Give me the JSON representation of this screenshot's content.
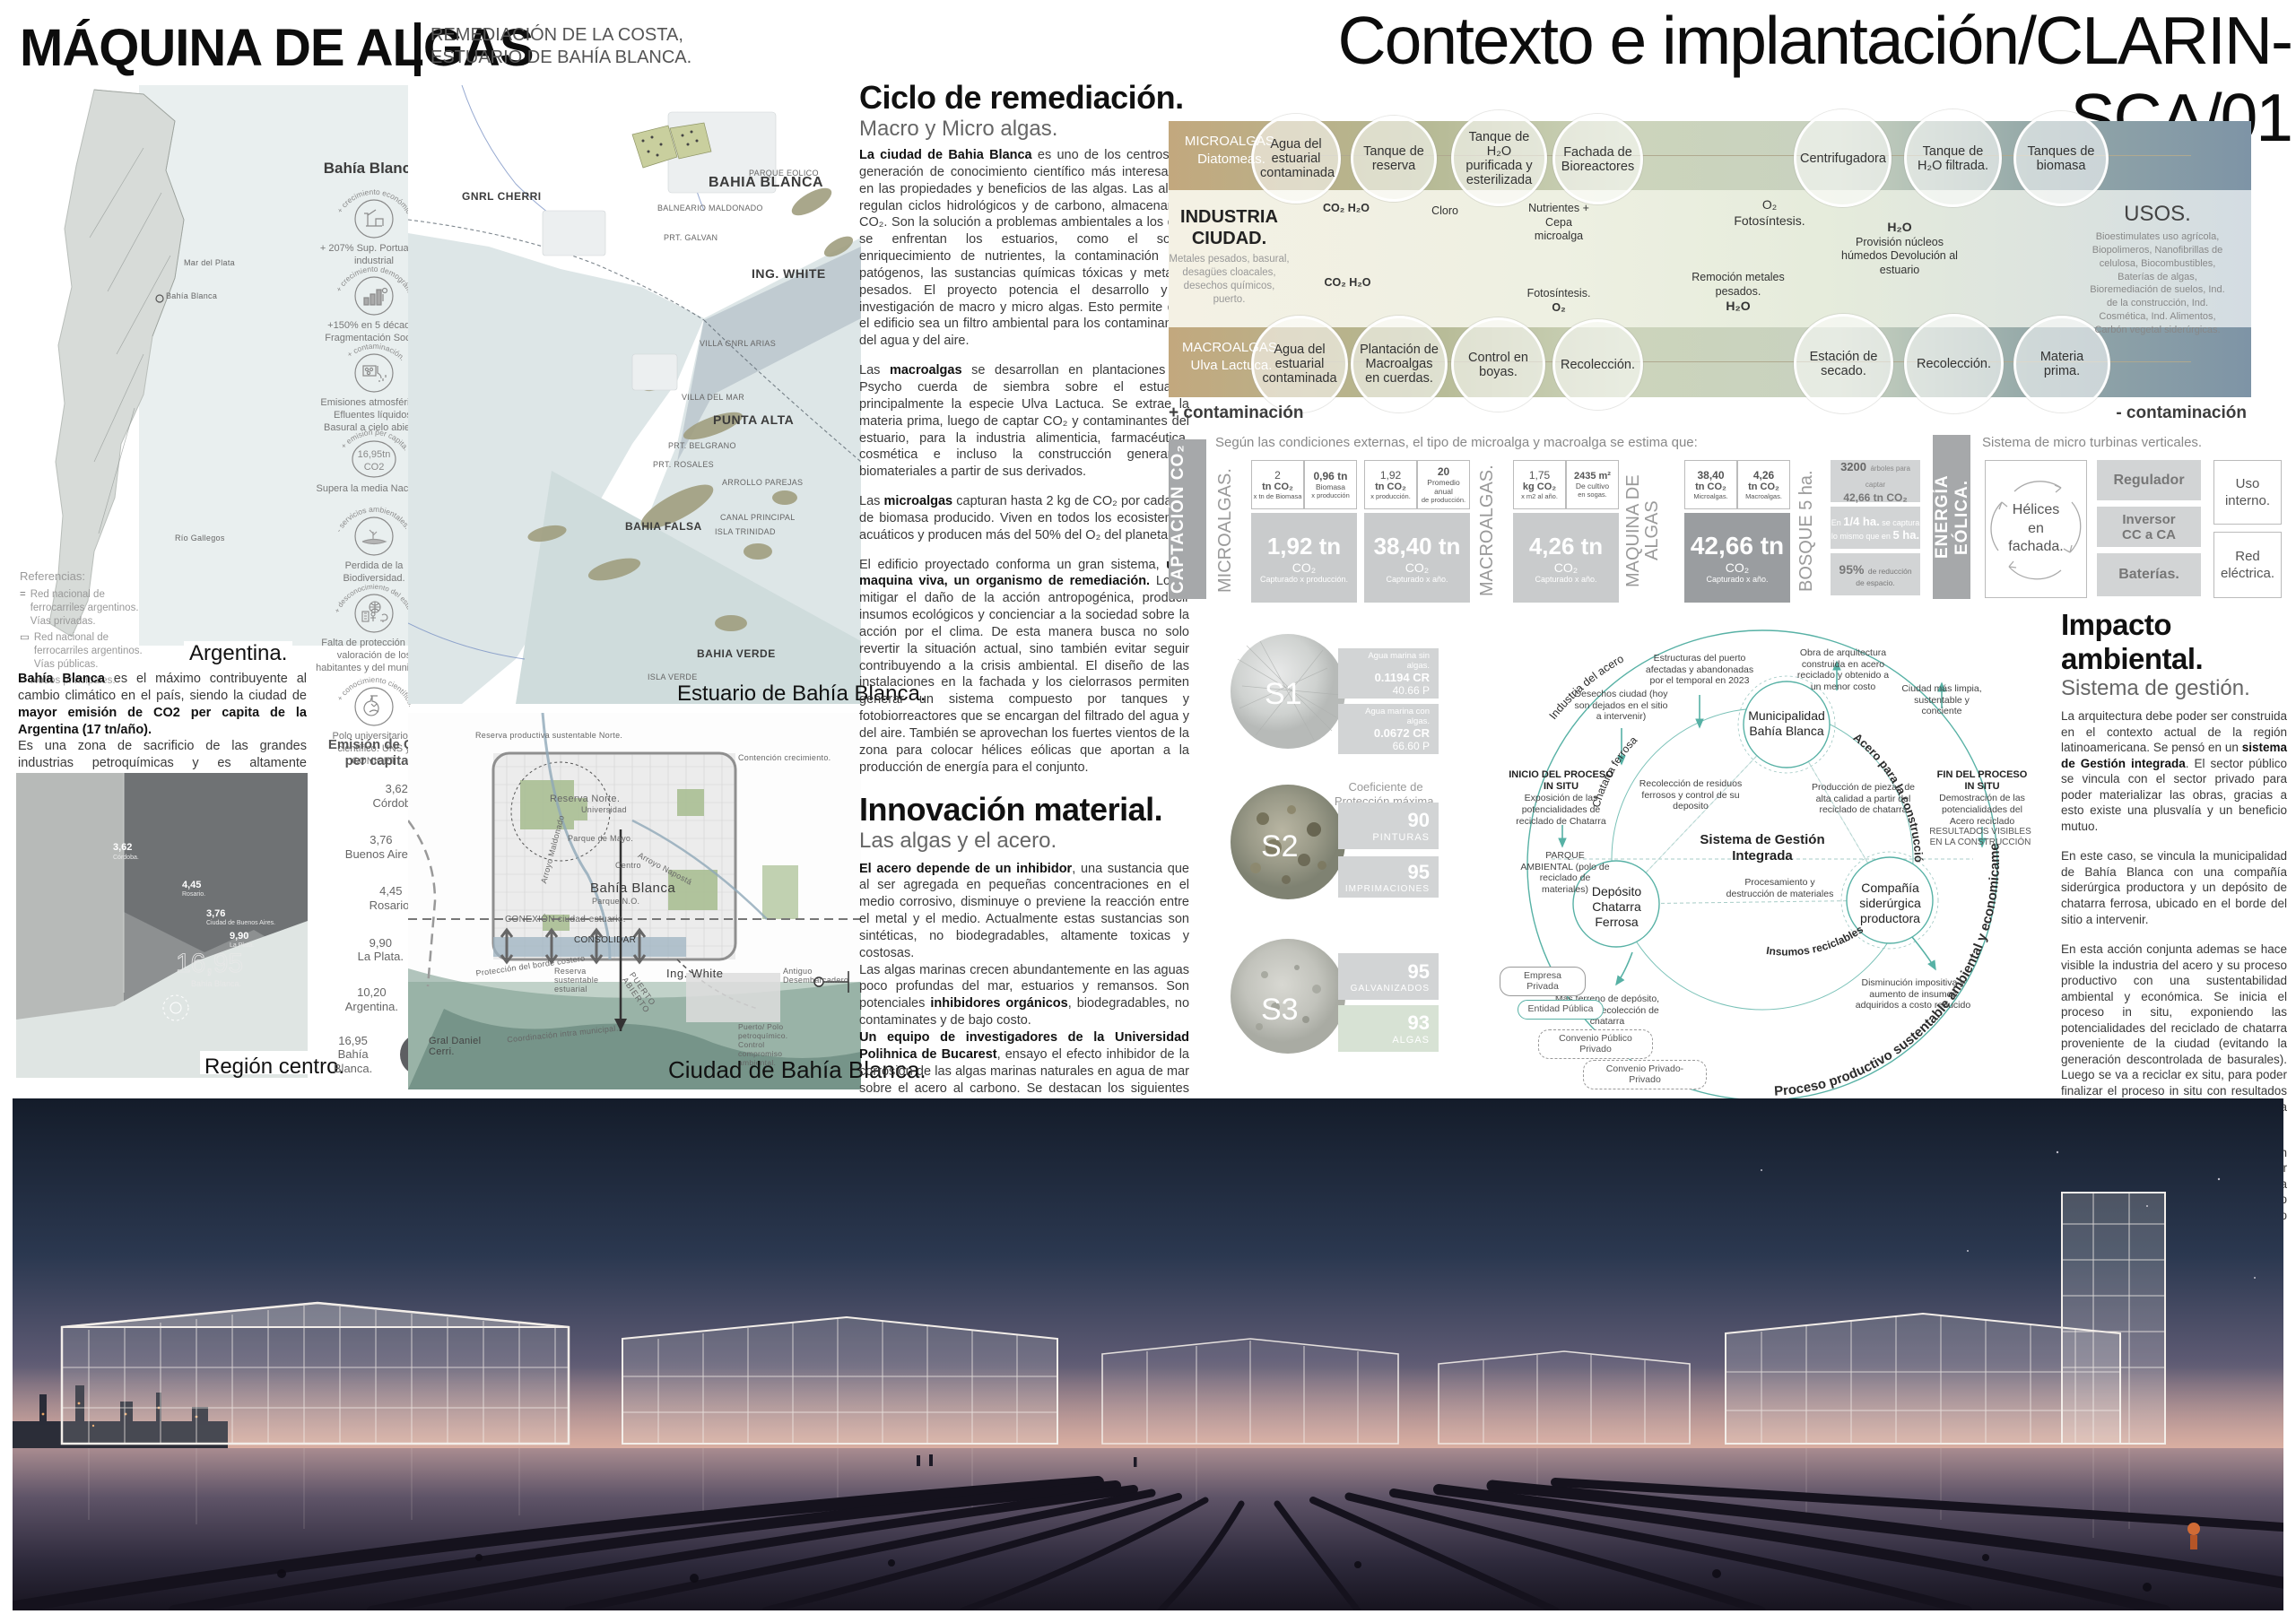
{
  "palette": {
    "tan": "#c0a67c",
    "olive": "#aab48e",
    "sage": "#cfd6bd",
    "steel": "#7e94a6",
    "teal": "#57b1a5",
    "gray_bar": "#a6a8aa",
    "cell_gray": "#d8d9da",
    "cell_dark": "#9a9da0",
    "algae_green": "#d7e2d4"
  },
  "header": {
    "title": "MÁQUINA DE ALGAS",
    "subtitle_line1": "REMEDIACIÓN DE LA COSTA,",
    "subtitle_line2": "ESTUARIO DE BAHÍA BLANCA.",
    "sheet_title": "Contexto e implantación/CLARIN-SCA/01"
  },
  "left": {
    "argentina_caption": "Argentina.",
    "region_caption": "Región centro.",
    "map_label_rio_gallegos": "Río Gallegos",
    "map_label_bahia": "Bahía Blanca",
    "map_label_mar": "Mar del Plata",
    "referencias": {
      "title": "Referencias:",
      "item1": "Red nacional de ferrocarriles argentinos. Vías privadas.",
      "item2": "Red nacional de ferrocarriles argentinos. Vías públicas.",
      "item3": "Nodos principales."
    },
    "bahia_header": "Bahía Blanca:",
    "icons": [
      {
        "arc": "+ crecimiento económico.",
        "caption": "+ 207% Sup. Portuaria e industrial"
      },
      {
        "arc": "+ crecimiento demográfico.",
        "caption": "+150% en 5 décadas Fragmentación Social."
      },
      {
        "arc": "+ contaminación.",
        "caption": "Emisiones atmosféricas. Efluentes líquidos. Basural a cielo abierto."
      },
      {
        "arc": "+ emisión per capita.",
        "caption": "Supera la media Nacional.",
        "value_line1": "16,95tn",
        "value_line2": "CO2"
      },
      {
        "arc": "- servicios ambientales.",
        "caption": "Perdida de la Biodiversidad."
      },
      {
        "arc": "+ desconocimiento del estuario.",
        "caption": "Falta de protección y de valoración de los habitantes y del municipio."
      },
      {
        "arc": "+ conocimiento científico.",
        "caption": "Polo universitario y científico. UNS y CONICET"
      }
    ],
    "para": {
      "b1": "Bahía Blanca",
      "t1": " es el máximo contribuyente al cambio climático en el país, siendo la ciudad de ",
      "b2": "mayor emisión de CO2 per capita de la Argentina (17 tn/año).",
      "t2": "Es una zona de sacrificio de las grandes industrias petroquímicas y es altamente vulnerable a la subida del nivel del mar, poniendo en riesgo a sus más de 300.000 habitantes."
    },
    "chart_data": {
      "type": "scatter",
      "title": "Emisión de CO₂ per capita:",
      "categories": [
        "Córdoba.",
        "Buenos Aires.",
        "Rosario.",
        "La Plata.",
        "Argentina.",
        "Bahía Blanca."
      ],
      "values": [
        3.62,
        3.76,
        4.45,
        9.9,
        10.2,
        16.95
      ],
      "value_labels": [
        "3,62",
        "3,76",
        "4,45",
        "9,90",
        "10,20",
        "16,95"
      ],
      "unit": "tn CO2 per capita"
    },
    "sat_bubbles": [
      {
        "v": "3,62",
        "n": "Córdoba."
      },
      {
        "v": "4,45",
        "n": "Rosario."
      },
      {
        "v": "3,76",
        "n": "Ciudad de Buenos Aires."
      },
      {
        "v": "9,90",
        "n": "La Plata."
      },
      {
        "v": "16,95",
        "n": "Bahía Blanca."
      }
    ]
  },
  "estuario": {
    "caption": "Estuario de Bahía Blanca.",
    "labels": [
      "GNRL CHERRI",
      "BAHIA BLANCA",
      "BALNEARIO MALDONADO",
      "PRT. GALVAN",
      "ING. WHITE",
      "VILLA GNRL ARIAS",
      "VILLA DEL MAR",
      "PUNTA ALTA",
      "PRT. BELGRANO",
      "PRT. ROSALES",
      "ARROLLO PAREJAS",
      "CANAL PRINCIPAL",
      "PARQUE EOLICO",
      "BAHIA FALSA",
      "ISLA TRINIDAD",
      "BAHIA VERDE",
      "ISLA VERDE"
    ]
  },
  "ciudad": {
    "caption": "Ciudad de Bahía Blanca.",
    "labels": [
      "Reserva productiva sustentable Norte.",
      "Contención crecimiento.",
      "Reserva Norte.",
      "Universidad",
      "Parque de Mayo.",
      "Arroyo Maldonado",
      "Arroyo Napostá",
      "Centro",
      "Bahía Blanca",
      "Parque N.O.",
      "CONEXIÓN ciudad-estuario.",
      "CONSOLIDAR",
      "Protección del borde costero",
      "Reserva sustentable estuarial",
      "Ing. White",
      "PUERTO ABIERTO",
      "Antiguo Desembarcadero",
      "Gral Daniel Cerri.",
      "Coordinación intra municipal.",
      "Puerto/ Polo petroquímico. Control compromiso ambiental."
    ]
  },
  "ciclo": {
    "h1": "Ciclo de remediación.",
    "h2": "Macro y Micro algas.",
    "p1b": "La ciudad de Bahia Blanca",
    "p1": " es uno de los centros de generación de conocimiento científico más interesados en las propiedades y beneficios de las algas. Las algas regulan ciclos hidrológicos y de carbono, almacenando CO₂. Son la solución a problemas ambientales a los que se enfrentan los estuarios, como el sobre enriquecimiento de nutrientes, la contaminación con patógenos, las sustancias químicas tóxicas y metales pesados. El proyecto potencia el desarrollo y la investigación de macro y micro algas. Esto permite que el edificio sea un filtro ambiental para los contaminantes del agua y del aire.",
    "p2a": "Las ",
    "p2b": "macroalgas",
    "p2": " se desarrollan en plantaciones de Psycho cuerda de siembra sobre el estuario, principalmente la especie Ulva Lactuca. Se extrae la materia prima, luego de captar CO₂ y contaminantes del estuario, para la industria alimenticia, farmacéutica, cosmética e incluso la construcción generando biomateriales a partir de sus derivados.",
    "p3a": "Las ",
    "p3b": "microalgas",
    "p3": " capturan hasta 2 kg de CO₂ por cada kg de biomasa producido. Viven en todos los ecosistemas acuáticos y producen más del 50% del O₂ del planeta.",
    "p4a": "El edificio proyectado conforma un gran sistema, ",
    "p4b": "una maquina viva, un organismo de remediación.",
    "p4": " Logra mitigar el daño de la acción antropogénica, producir insumos ecológicos y concienciar a la sociedad sobre la acción por el clima. De esta manera busca no solo revertir la situación actual, sino también evitar seguir contribuyendo a la crisis ambiental. El diseño de las instalaciones en la fachada y los cielorrasos permiten generar un sistema compuesto por tanques y fotobiorreactores que se encargan del filtrado del agua y del aire. También se aprovechan los fuertes vientos de la zona para colocar hélices eólicas que aportan a la producción de energía para el conjunto."
  },
  "innovacion": {
    "h1": "Innovación material.",
    "h2": "Las algas y el acero.",
    "p1b": "El acero depende de un inhibidor",
    "p1": ", una sustancia que al ser agregada en pequeñas concentraciones en el medio corrosivo, disminuye o previene la reacción entre el metal y el medio. Actualmente estas sustancias son sintéticas, no biodegradables, altamente toxicas y costosas.",
    "p2a": "Las algas marinas crecen abundantemente en las aguas poco profundas del mar, estuarios y remansos. Son potenciales ",
    "p2b": "inhibidores orgánicos",
    "p2": ", biodegradables, no contaminates y de bajo costo.",
    "p3b": "Un equipo de investigadores de la  Universidad Polihnica de Bucarest",
    "p3": ",  ensayo el efecto inhibidor de la corrosión de las algas marinas naturales en agua de mar sobre el acero al carbono. Se destacan los siguientes resultados de Velocidad de corrosión CR (g/m2 h) y grado de protección  P(%) en las siguientes morfologías superficiales del acero:",
    "s1": "- (S1) En blanco = CR 0.2012 / P-",
    "s2": "- (S2) Sumergido en agua de mar sin algas naturales  = CR 0.1194 / P- 40.66",
    "s3": "- (S3) Sumergido en agua de mar con algas naturales = CR 0.0672 / P- 66.60",
    "p4a": "Teniendo en cuenta esto, se plantea en el proyecto el ",
    "p4b": "uso de extracto de algas como inhibidor de la corrosión",
    "p4": " para evitar utilizar métodos contaminantes. Por otro lado, se  incorporan algas nativas en el agua en el cual se sumerge la estructura para aumentar su grado de protección y disminuir su velocidad de corrosión,prolongando la vida útil mas larga y con menor impacto ambiental."
  },
  "flow": {
    "micro_label1": "MICROALGAS.",
    "micro_label2": "Diatomeas.",
    "macro_label1": "MACROALGAS.",
    "macro_label2": "Ulva Lactuca.",
    "industria_t": "INDUSTRIA CIUDAD.",
    "industria_s": "Metales pesados, basural, desagües cloacales, desechos químicos, puerto.",
    "top_circles": [
      "Agua del estuarial contaminada",
      "Tanque de reserva",
      "Tanque de H₂O purificada y esterilizada",
      "Fachada de Bioreactores",
      "Centrifugadora",
      "Tanque de H₂O filtrada.",
      "Tanques de biomasa"
    ],
    "bottom_circles": [
      "Agua del estuarial contaminada",
      "Plantación de Macroalgas en cuerdas.",
      "Control en boyas.",
      "Recolección.",
      "Estación de secado.",
      "Recolección.",
      "Materia prima."
    ],
    "ann_co2_h2o_top": "CO₂ H₂O",
    "ann_cloro": "Cloro",
    "ann_nutrientes": "Nutrientes + Cepa microalga",
    "ann_o2_foto": "O₂ Fotosíntesis.",
    "ann_h2o": "H₂O",
    "ann_provision": "Provisión núcleos húmedos Devolución al estuario",
    "ann_co2_h2o_bot": "CO₂ H₂O",
    "ann_foto_o2a": "Fotosíntesis.",
    "ann_foto_o2b": "O₂",
    "ann_remocion": "Remoción metales pesados.",
    "ann_remocion_h2o": "H₂O",
    "usos_t": "USOS.",
    "usos": "Bioestimulates uso agrícola, Biopolimeros, Nanofibrillas de celulosa, Biocombustibles, Baterías de algas, Bioremediación de suelos, Ind. de la construcción, Ind. Cosmética, Ind. Alimentos, Carbón vegetal siderúrgicas.",
    "plus": "+ contaminación",
    "minus": "- contaminación"
  },
  "captacion": {
    "bar": "CAPTACIÓN CO₂",
    "intro": "Según las condiciones externas, el tipo de microalga y macroalga se estima que:",
    "chart_data": {
      "type": "table",
      "title": "Captación CO₂",
      "groups": [
        {
          "group": "MICROALGAS.",
          "inputs": [
            "2 tn CO₂ x tn de Biomasa",
            "0,96 tn Biomasa x producción"
          ],
          "result": "1,92 tn CO₂ Capturado x producción."
        },
        {
          "group": "MICROALGAS.",
          "inputs": [
            "1,92 tn CO₂ x producción.",
            "20 Promedio anual de producción."
          ],
          "result": "38,40 tn CO₂ Capturado x año."
        },
        {
          "group": "MACROALGAS.",
          "inputs": [
            "1,75 kg CO₂ x m2 al año.",
            "2435 m² De cultivo en sogas."
          ],
          "result": "4,26 tn CO₂ Capturado x año."
        },
        {
          "group": "MAQUINA DE ALGAS",
          "inputs": [
            "38,40 tn CO₂ Microalgas.",
            "4,26 tn CO₂ Macroalgas."
          ],
          "result": "42,66 tn CO₂ Capturado x año."
        }
      ],
      "bosque": [
        "3200 árboles para captar 42,66 tn CO₂",
        "En 1/4 ha. se captura lo mismo que en 5 ha.",
        "95% de reducción de espacio."
      ]
    },
    "v_micro": "MICROALGAS.",
    "v_macro": "MACROALGAS.",
    "v_maq1": "MAQUINA DE",
    "v_maq2": "ALGAS",
    "v_bosque": "BOSQUE 5 ha.",
    "g1": {
      "a1": "2",
      "a2": "tn CO₂",
      "a3": "x tn de Biomasa",
      "b1": "0,96 tn",
      "b2": "Biomasa",
      "b3": "x producción",
      "r1": "1,92 tn",
      "r2": "CO₂",
      "r3": "Capturado x producción."
    },
    "g2": {
      "a1": "1,92",
      "a2": "tn CO₂",
      "a3": "x producción.",
      "b1": "20",
      "b2": "Promedio anual",
      "b3": "de producción.",
      "r1": "38,40 tn",
      "r2": "CO₂",
      "r3": "Capturado x año."
    },
    "g3": {
      "a1": "1,75",
      "a2": "kg CO₂",
      "a3": "x m2 al año.",
      "b1": "2435 m²",
      "b2": "De cultivo",
      "b3": "en sogas.",
      "r1": "4,26 tn",
      "r2": "CO₂",
      "r3": "Capturado x año."
    },
    "g4": {
      "a1": "38,40",
      "a2": "tn CO₂",
      "a3": "Microalgas.",
      "b1": "4,26",
      "b2": "tn CO₂",
      "b3": "Macroalgas.",
      "r1": "42,66 tn",
      "r2": "CO₂",
      "r3": "Capturado x año."
    },
    "bq1a": "3200",
    "bq1b": "árboles para captar",
    "bq1c": "42,66 tn CO₂",
    "bq2a": "En ",
    "bq2b": "1/4 ha.",
    "bq2c": " se captura",
    "bq2d": "lo mismo que en ",
    "bq2e": "5 ha.",
    "bq3a": "95%",
    "bq3b": "de reducción",
    "bq3c": "de espacio."
  },
  "eolica": {
    "bar": "ENERGÍA EÓLICA.",
    "intro": "Sistema de micro turbinas verticales.",
    "helices": "Hélices en fachada.",
    "b1": "Regulador",
    "b2": "Inversor CC a CA",
    "b3": "Baterías.",
    "o1": "Uso interno.",
    "o2": "Red eléctrica."
  },
  "samples": {
    "s1": "S1",
    "s2": "S2",
    "s3": "S3",
    "coef": "Coeficiente de Protección máxima.",
    "chart_data": {
      "type": "bar",
      "title": "Coeficiente de Protección máxima",
      "categories": [
        "PINTURAS",
        "IMPRIMACIONES",
        "GALVANIZADOS",
        "ALGAS"
      ],
      "values": [
        90,
        95,
        95,
        93
      ],
      "tests": [
        {
          "sample": "S1",
          "box1": "Agua marina sin algas. 0.1194 CR 40.66 P",
          "box2": "Agua marina con algas. 0.0672 CR 66.60 P"
        }
      ]
    },
    "b1l1": "Agua marina sin algas.",
    "b1l2": "0.1194 CR",
    "b1l3": "40.66 P",
    "b2l1": "Agua marina con algas.",
    "b2l2": "0.0672 CR",
    "b2l3": "66.60 P",
    "p1v": "90",
    "p1n": "PINTURAS",
    "p2v": "95",
    "p2n": "IMPRIMACIONES",
    "p3v": "95",
    "p3n": "GALVANIZADOS",
    "p4v": "93",
    "p4n": "ALGAS"
  },
  "gestion": {
    "arc_industria": "Industria del acero",
    "arc_chatarra": "Chatarra ferrosa",
    "arc_acero": "Acero para la construcción",
    "arc_insumos": "Insumos reciclables",
    "arc_proceso": "Proceso productivo sustentable ambiental y economicamente",
    "center1": "Sistema de Gestión",
    "center2": "Integrada",
    "node_muni": "Municipalidad Bahía Blanca",
    "node_deposito": "Depósito Chatarra Ferrosa",
    "node_comp": "Compañía siderúrgica productora",
    "t_estructuras": "Estructuras del puerto afectadas y abandonadas por el temporal en 2023",
    "t_desechos": "Desechos ciudad (hoy son dejados en el sitio a intervenir)",
    "t_obra": "Obra de arquitectura construida en acero reciclado y obtenido a un menor costo",
    "t_ciudad": "Ciudad más limpia, sustentable y conciente",
    "t_inicio_b": "INICIO DEL PROCESO IN SITU",
    "t_inicio": "Exposición de las potencialidades de reciclado de Chatarra",
    "t_parque": "PARQUE AMBIENTAL (polo de reciclado de materiales)",
    "t_recoleccion": "Recolección de residuos ferrosos y control de su deposito",
    "t_produccion": "Producción de piezas de alta calidad a partir del reciclado de chatarra",
    "t_fin_b": "FIN DEL PROCESO IN SITU",
    "t_fin": "Demostración de las potencialidades del Acero reciclado",
    "t_resultados": "RESULTADOS VISIBLES EN LA CONSTRUCCIÓN",
    "t_procesamiento": "Procesamiento y destrucción de materiales",
    "t_terreno": "Más terreno de depósito, ahorro en recolección de chatarra",
    "t_disminucion": "Disminución impositiva y aumento de insumos adquiridos a costo reducido",
    "pill1": "Empresa Privada",
    "pill2": "Entidad Pública",
    "pill3": "Convenio Público Privado",
    "pill4": "Convenio Privado-Privado"
  },
  "impacto": {
    "h1": "Impacto ambiental.",
    "h2": "Sistema de gestión.",
    "p1a": "La arquitectura debe poder ser construida  en el contexto actual de la región latinoamericana. Se pensó en un ",
    "p1b": "sistema de Gestión integrada",
    "p1": ". El sector público se vincula con el sector privado para poder materializar las obras, gracias a esto existe una plusvalía y un beneficio mutuo.",
    "p2": "En  este caso, se vincula la municipalidad de Bahía Blanca con una compañía siderúrgica productora y un depósito de chatarra ferrosa, ubicado en el borde del sitio a intervenir.",
    "p3": "En esta acción conjunta ademas se hace visible la industria del acero y su proceso productivo con una sustentabilidad ambiental y económica. Se inicia el proceso in situ, exponiendo las potencialidades del reciclado de chatarra proveniente de la ciudad (evitando la generación descontrolada de basurales). Luego se va a reciclar ex situ, para poder finalizar el proceso in situ con resultados visibles en una obra de arquitectura concretada.",
    "p4": "El  proyecto  entiende  que  su  implantación conlleva un impacto, el cual busca reducir lo mas posible en durante el montaje, la vida útil (capturando CO₂ y produciendo energías renovables) y el futuro desmontaje."
  }
}
